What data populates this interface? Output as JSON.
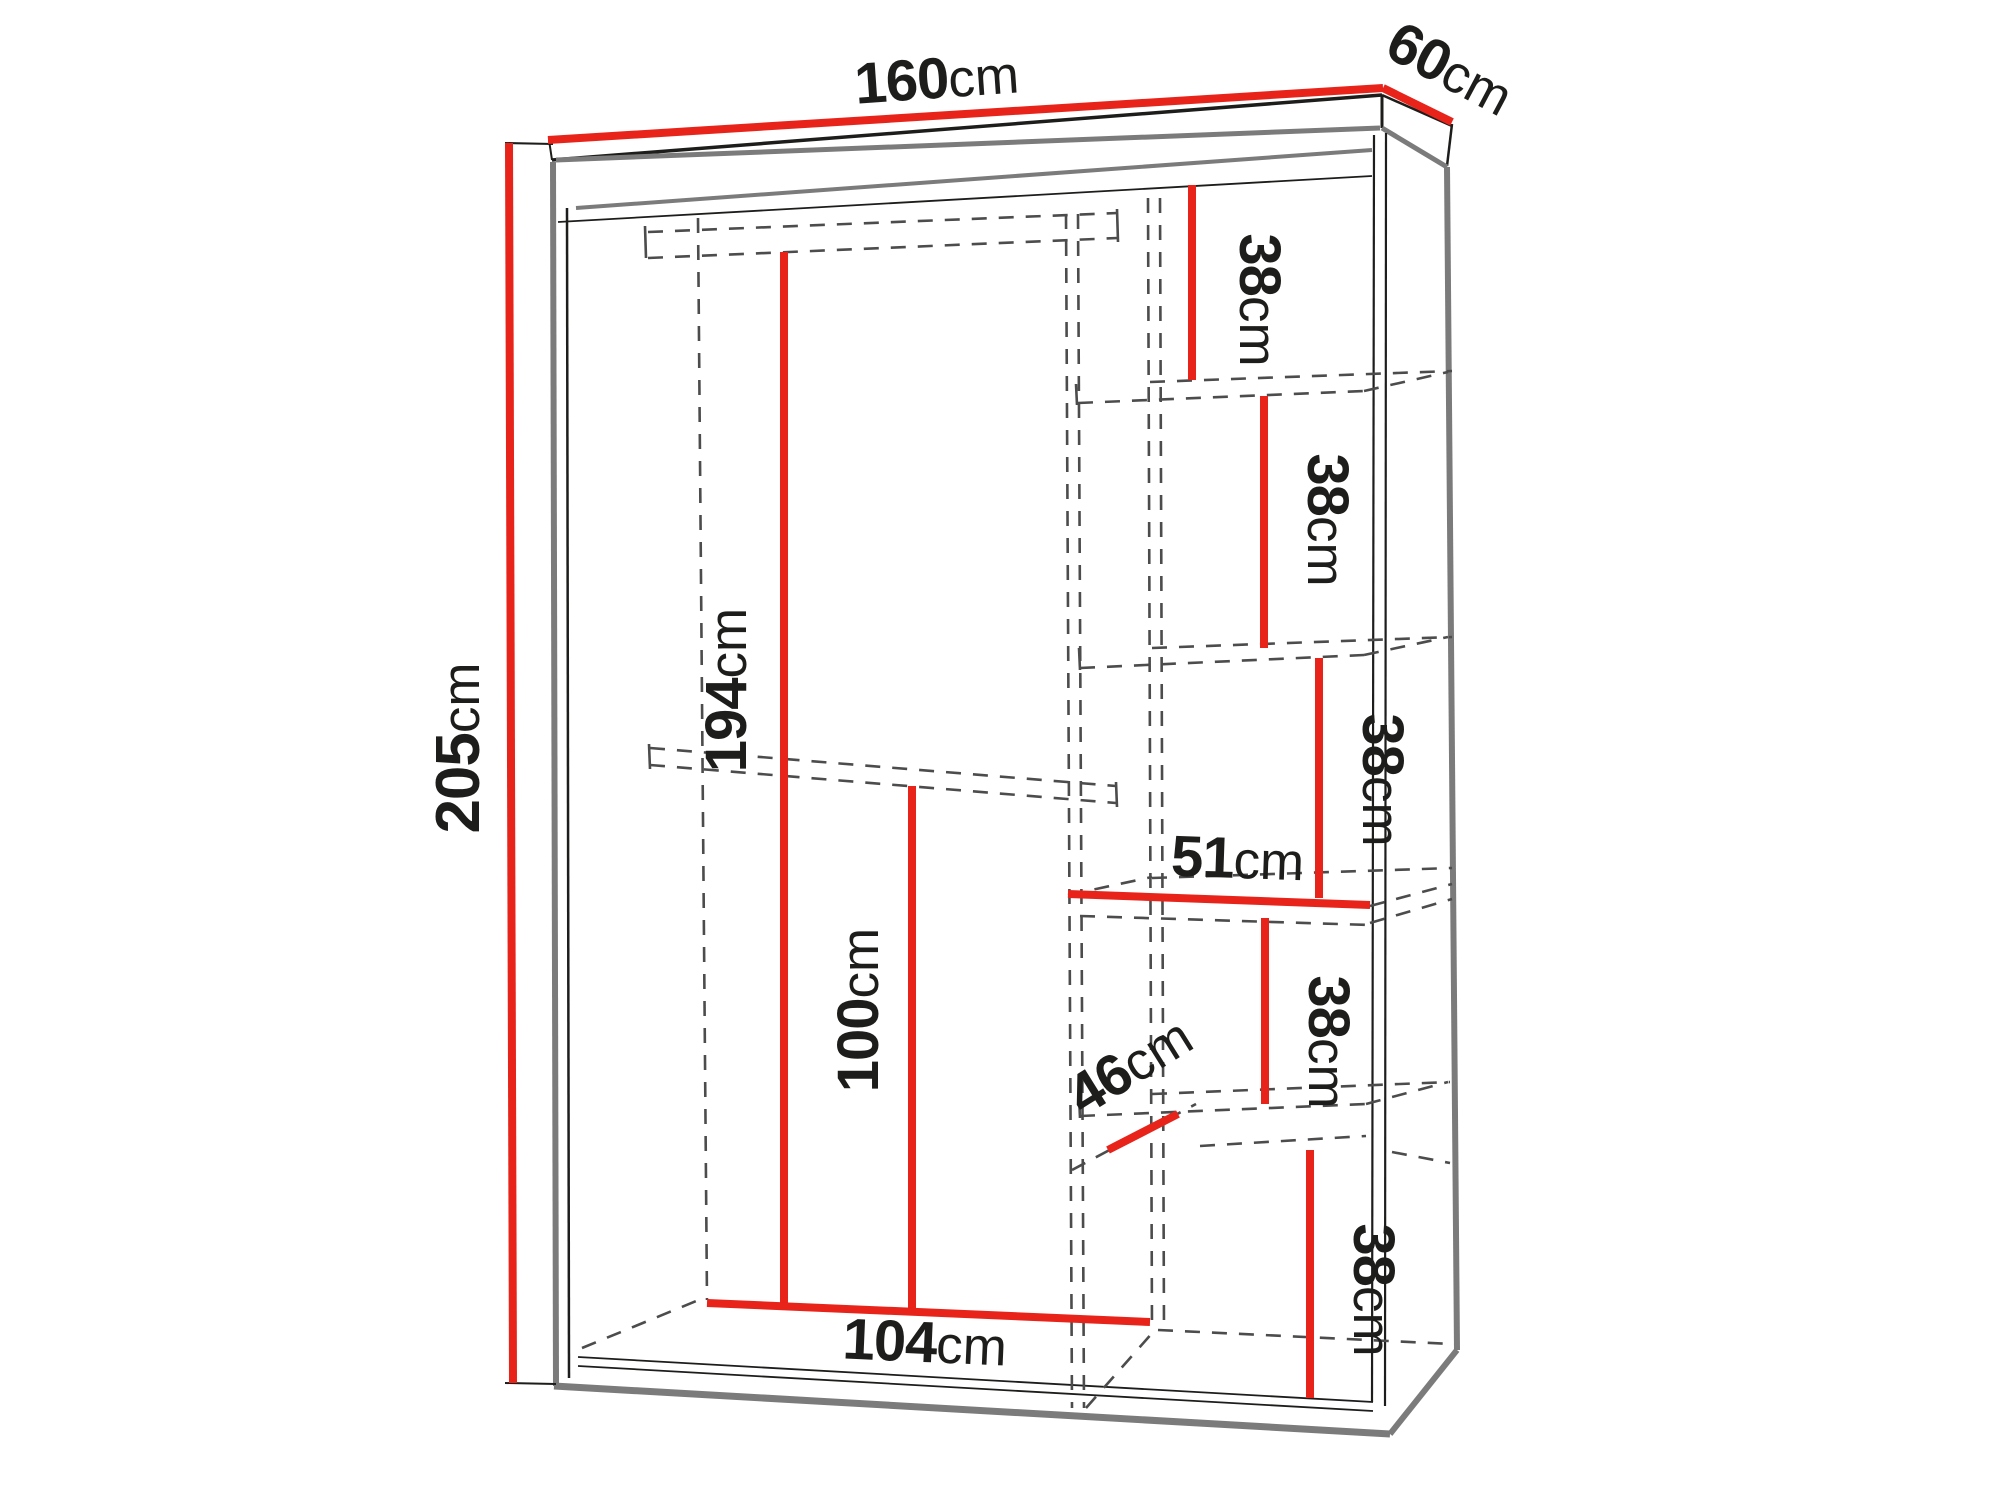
{
  "page": {
    "background": "#ffffff"
  },
  "colors": {
    "background": "#ffffff",
    "dimension_red": "#e8231a",
    "line_black": "#1d1d1b",
    "outline_gray": "#7b7b7b",
    "dashed_gray": "#4c4c4c"
  },
  "diagram": {
    "type": "furniture-dimension-diagram",
    "subject": "sliding-door wardrobe with shelves and hanging rod",
    "unit": "cm",
    "labels": {
      "width": {
        "value": "160",
        "unit": "cm"
      },
      "depth": {
        "value": "60",
        "unit": "cm"
      },
      "height": {
        "value": "205",
        "unit": "cm"
      },
      "interior_height": {
        "value": "194",
        "unit": "cm"
      },
      "lower_height": {
        "value": "100",
        "unit": "cm"
      },
      "interior_width": {
        "value": "104",
        "unit": "cm"
      },
      "shelf_gap_1": {
        "value": "38",
        "unit": "cm"
      },
      "shelf_gap_2": {
        "value": "38",
        "unit": "cm"
      },
      "shelf_gap_3": {
        "value": "38",
        "unit": "cm"
      },
      "shelf_gap_4": {
        "value": "38",
        "unit": "cm"
      },
      "shelf_gap_5": {
        "value": "38",
        "unit": "cm"
      },
      "shelf_width": {
        "value": "51",
        "unit": "cm"
      },
      "shelf_depth": {
        "value": "46",
        "unit": "cm"
      }
    }
  }
}
